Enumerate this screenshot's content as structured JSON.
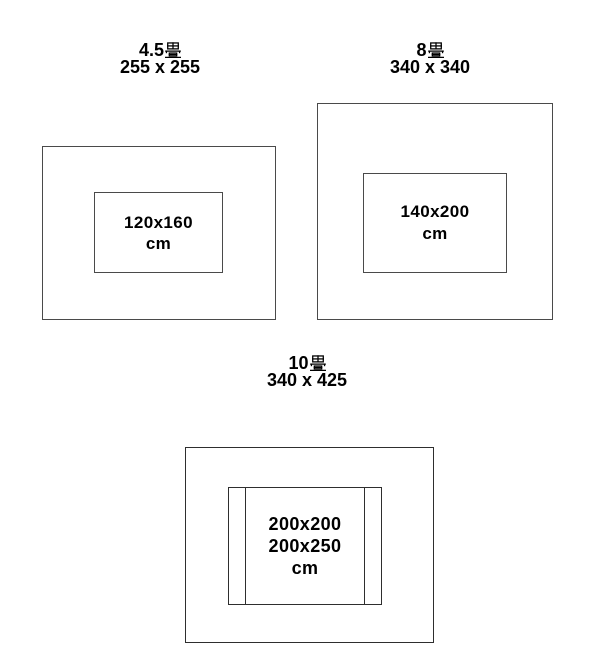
{
  "page": {
    "background_color": "#ffffff",
    "outline_color": "#4a4a4a",
    "outline_color_dark": "#2e2e2e",
    "text_color": "#000000"
  },
  "diagrams": [
    {
      "room_size_value": "4.5",
      "room_unit": "畳",
      "room_dimensions": "255 x 255",
      "rug_lines": [
        "120x160",
        "cm"
      ]
    },
    {
      "room_size_value": "8",
      "room_unit": "畳",
      "room_dimensions": "340 x 340",
      "rug_lines": [
        "140x200",
        "cm"
      ]
    },
    {
      "room_size_value": "10",
      "room_unit": "畳",
      "room_dimensions": "340 x 425",
      "rug_lines": [
        "200x200",
        "200x250",
        "cm"
      ]
    }
  ]
}
